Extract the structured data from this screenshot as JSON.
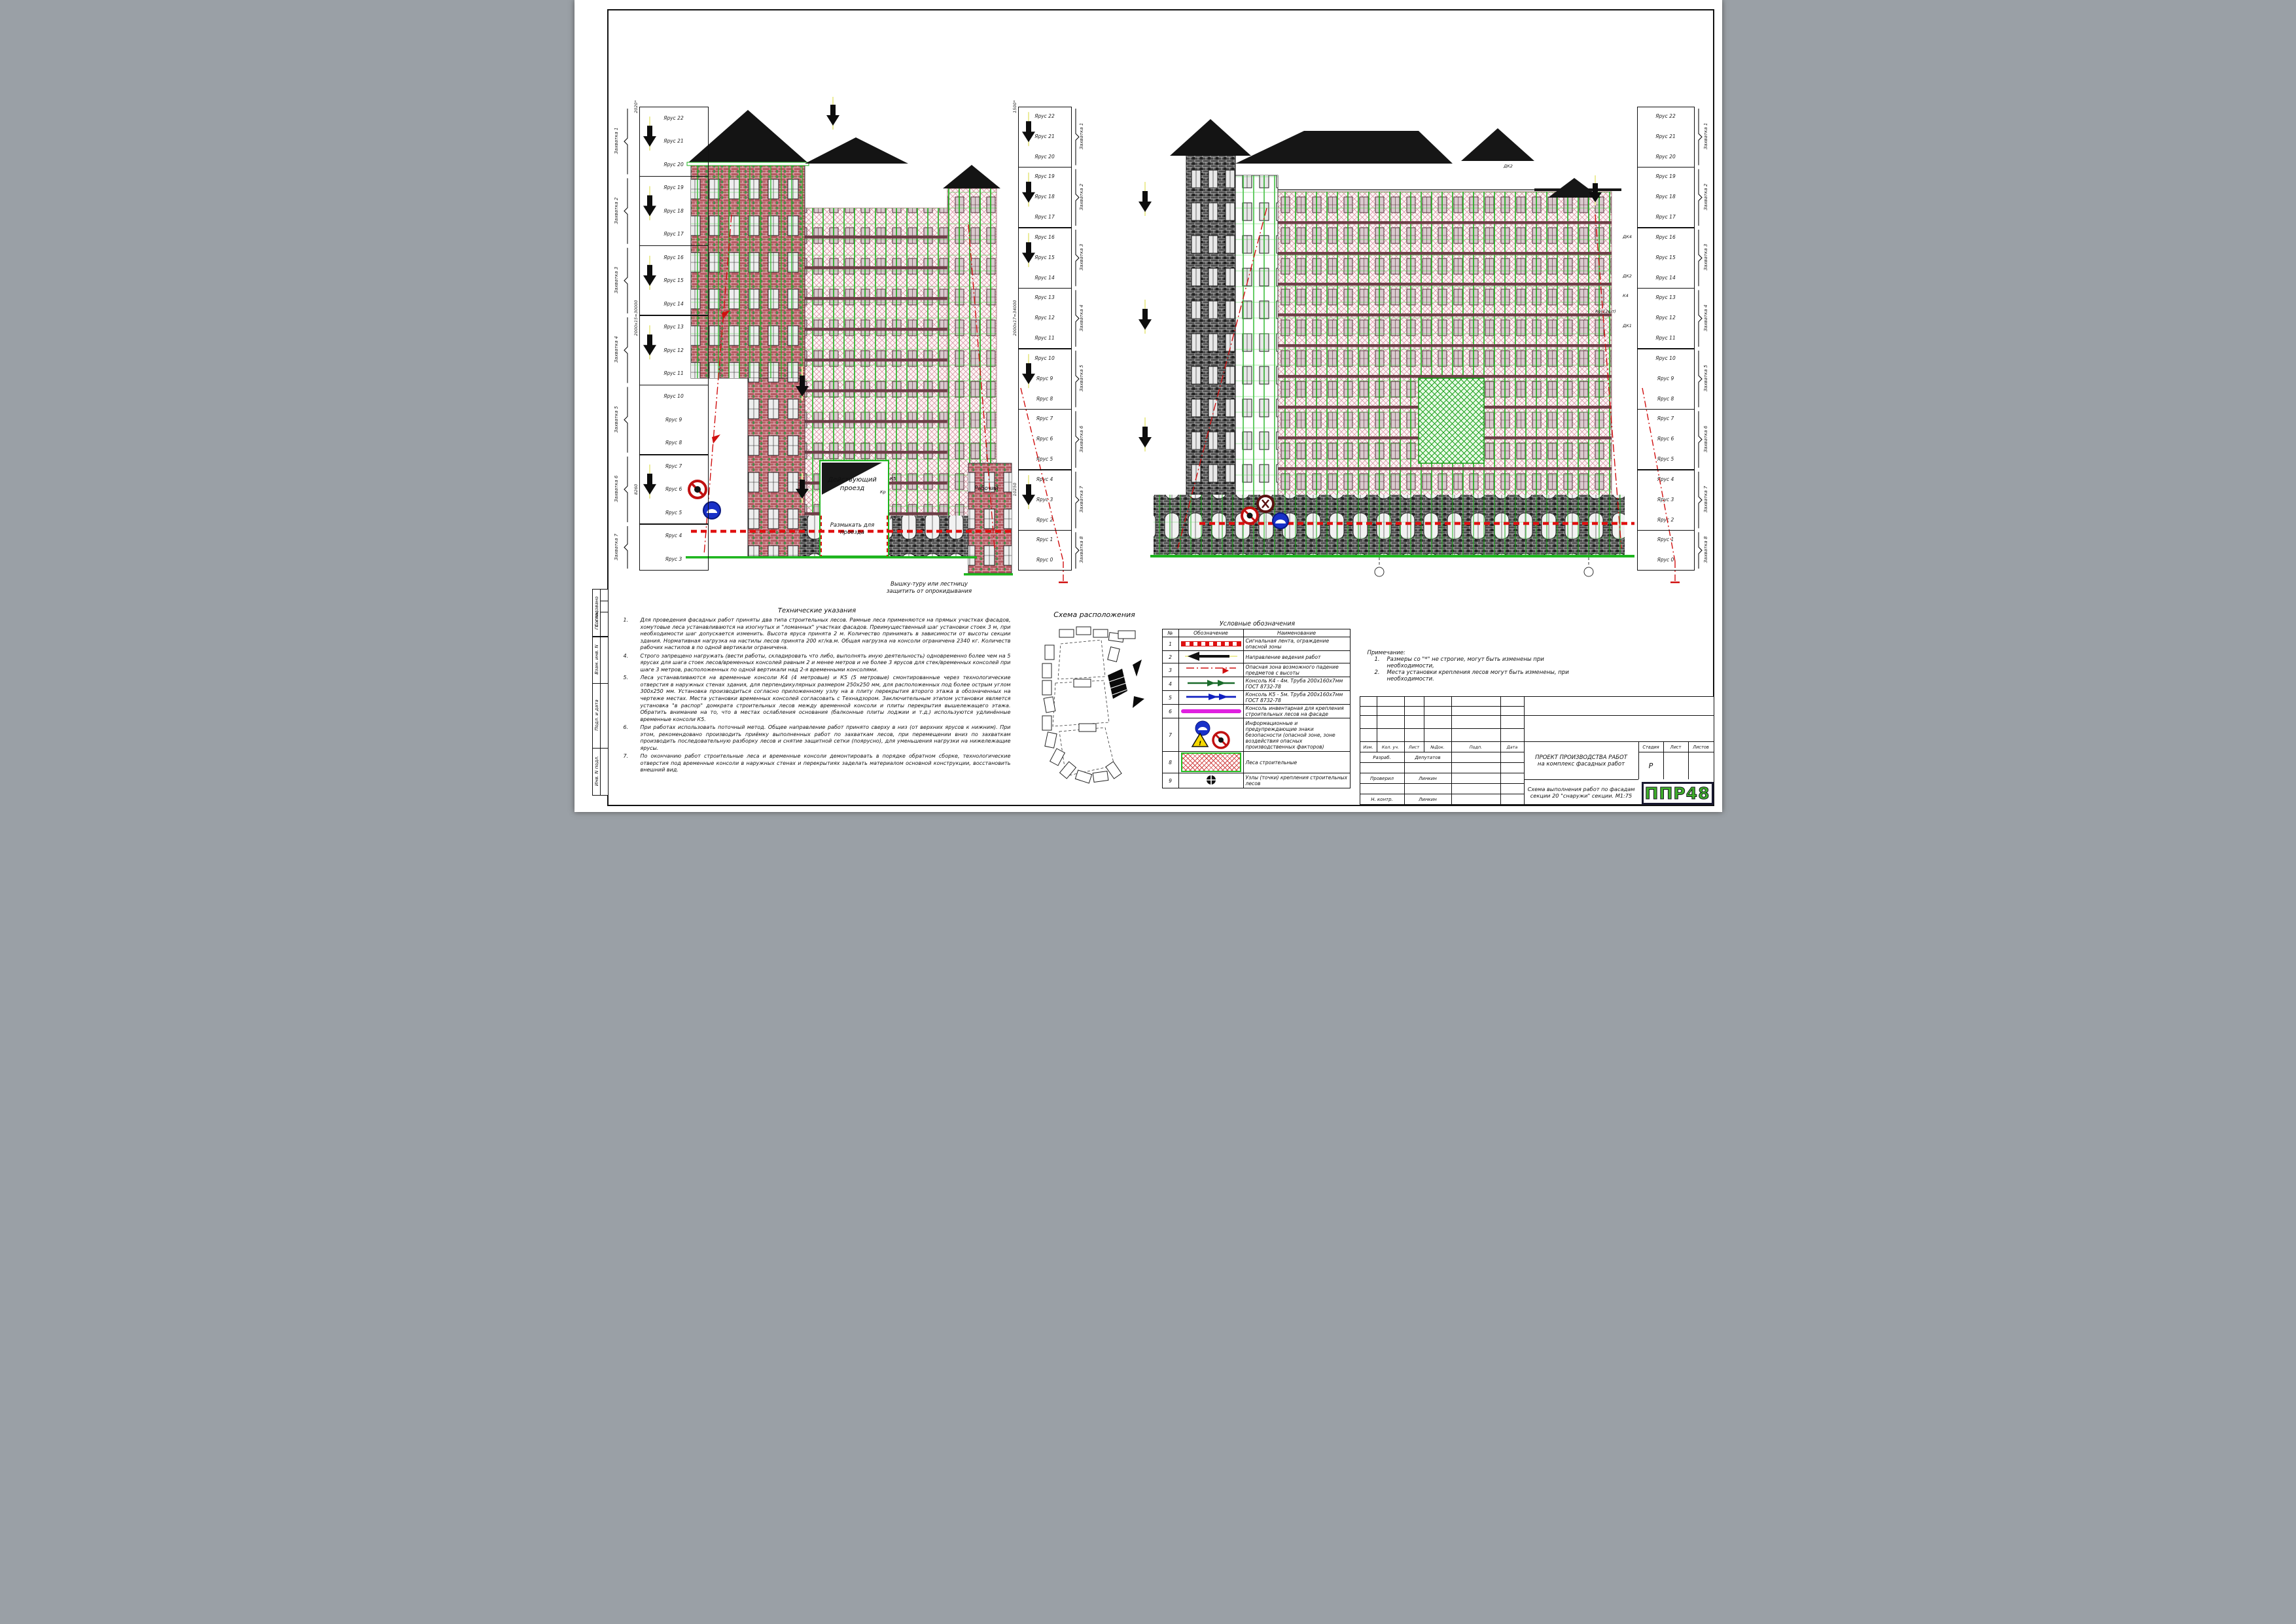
{
  "sheet_name": "Схема выполнения работ по фасадам секции 20",
  "sidebar": {
    "items": [
      "Согласовано",
      "Гл. спец.",
      "Взам. инв. N",
      "Подл. и дата",
      "Инв. N подл."
    ]
  },
  "ladders": {
    "tier_prefix": "Ярус",
    "group_prefix": "Захватка",
    "left": {
      "top_tier": 22,
      "bottom_tier": 3,
      "groups": [
        "Захватка 1",
        "Захватка 2",
        "Захватка 3",
        "Захватка 4",
        "Захватка 5",
        "Захватка 6",
        "Захватка 7"
      ],
      "dims": {
        "top": "2020*",
        "mid": "2000х15=30000",
        "bot": "8260"
      }
    },
    "middle": {
      "top_tier": 22,
      "bottom_tier": 0,
      "groups": [
        "Захватка 1",
        "Захватка 2",
        "Захватка 3",
        "Захватка 4",
        "Захватка 5",
        "Захватка 6",
        "Захватка 7",
        "Захватка 8"
      ],
      "dims": {
        "top": "1500*",
        "mid": "2000х17=34000",
        "bot": "10250"
      }
    },
    "right": {
      "top_tier": 22,
      "bottom_tier": 0,
      "groups": [
        "Захватка 1",
        "Захватка 2",
        "Захватка 3",
        "Захватка 4",
        "Захватка 5",
        "Захватка 6",
        "Захватка 7",
        "Захватка 8"
      ],
      "dims": {
        "top": "",
        "mid": "",
        "bot": ""
      }
    }
  },
  "facade1": {
    "labels": {
      "passage_l1": "Действующий",
      "passage_l2": "проезд",
      "open_l1": "Размыкать для",
      "open_l2": "проезда",
      "tower_l1": "Вышку-туру или лестницу",
      "tower_l2": "защитить от опрокидывания",
      "worker": "Рабочий"
    },
    "tags": {
      "t1": "К5",
      "t2": "Кр",
      "t3": "К5"
    }
  },
  "facade2": {
    "tags": {
      "t1": "ДК2",
      "t2": "ДК4",
      "t3": "ДК2",
      "t4": "К4",
      "t5": "ДК1",
      "t6": "Кр(12шт)"
    }
  },
  "tech_notes": {
    "title": "Технические указания",
    "items": [
      {
        "n": "1.",
        "text": "Для проведения фасадных работ приняты два типа строительных лесов. Рамные леса применяются на прямых участках фасадов, хомутовые леса устанавливаются на изогнутых и \"ломанных\" участках фасадов. Преимущественный шаг установки стоек 3 м, при необходимости шаг допускается изменить. Высота яруса принята 2 м. Количество принимать в зависимости от высоты секции здания. Нормативная нагрузка на настилы лесов принята 200 кг/кв.м. Общая нагрузка на консоли ограничена 2340 кг. Количеств рабочих настилов в по одной вертикали ограничена."
      },
      {
        "n": "4.",
        "text": "Строго запрещено нагружать (вести работы, складировать что либо, выполнять иную деятельность) одновременно более чем на 5 ярусах для шага стоек лесов/временных консолей равным 2 и менее метров и не более 3 ярусов для стек/временных консолей при шаге 3 метров, расположенных по одной вертикали над 2-я временными консолями."
      },
      {
        "n": "5.",
        "text": "Леса устанавливаются на временные консоли К4 (4 метровые) и К5 (5 метровые) смонтированные через технологические отверстия в наружных стенах здания, для перпендикулярных размером 250х250 мм, для расположенных под более острым углом 300х250 мм. Установка производиться согласно приложенному узлу на в плиту перекрытия второго этажа в обозначенных на чертеже местах. Места установки временных консолей согласовать с Технадзором. Заключительным этапом установки является установка \"в распор\" домкрата строительных лесов между временной консоли и плиты перекрытия вышележащего этажа. Обратить внимание на то, что в местах ослабления основания (балконные плиты лоджии и т.д.) используются удлинённые временные консоли К5."
      },
      {
        "n": "6.",
        "text": "При работах использовать поточный метод. Общее направление работ принято сверху в низ (от верхних ярусов к нижним). При этом, рекомендовано производить приёмку выполненных работ по захваткам лесов, при перемещении вниз по захваткам производить последовательную разборку лесов и снятие защитной сетки (поярусно), для уменьшения нагрузки на нижележащие ярусы."
      },
      {
        "n": "7.",
        "text": "По окончанию работ строительные леса и временные консоли демонтировать в порядке обратном сборке, технологические отверстия под временные консоли в наружных стенах и перекрытиях заделать материалом основной конструкции, восстановить внешний вид."
      }
    ]
  },
  "key_plan": {
    "title": "Схема расположения"
  },
  "legend": {
    "title": "Условные обозначения",
    "headers": [
      "№",
      "Обозначение",
      "Наименование"
    ],
    "rows": [
      {
        "n": "1",
        "icon": "signal-tape",
        "name": "Сигнальная лента, ограждение опасной зоны"
      },
      {
        "n": "2",
        "icon": "direction-arrow",
        "name": "Направление ведения работ"
      },
      {
        "n": "3",
        "icon": "danger-line",
        "name": "Опасная зона возможного падение предметов с высоты"
      },
      {
        "n": "4",
        "icon": "console-k4",
        "name": "Консоль К4 - 4м. Труба 200х160х7мм ГОСТ 8732-78"
      },
      {
        "n": "5",
        "icon": "console-k5",
        "name": "Консоль К5 - 5м. Труба 200х160х7мм ГОСТ 8732-78"
      },
      {
        "n": "6",
        "icon": "inventory-console",
        "name": "Консоль инвентарная для крепления строительных лесов на фасаде"
      },
      {
        "n": "7",
        "icon": "safety-signs",
        "name": "Информационные и предупреждающие знаки безопасности (опасной зоне, зоне воздействия опасных производственных факторов)"
      },
      {
        "n": "8",
        "icon": "scaffold",
        "name": "Леса строительные"
      },
      {
        "n": "9",
        "icon": "node",
        "name": "Узлы (точки) крепления строительных лесов"
      }
    ]
  },
  "notes": {
    "title": "Примечание:",
    "items": [
      {
        "n": "1.",
        "text": "Размеры со \"*\" не строгие, могут быть изменены при необходимости,"
      },
      {
        "n": "2.",
        "text": "Места установки крепления лесов могут быть изменены, при необходимости."
      }
    ]
  },
  "title_block": {
    "rev_headers": [
      "Изм.",
      "Кол. уч.",
      "Лист",
      "№Док.",
      "Подп.",
      "Дата"
    ],
    "rows": [
      {
        "role": "Разраб.",
        "name": "Депутатов"
      },
      {
        "role": "",
        "name": ""
      },
      {
        "role": "Проверил",
        "name": "Линкин"
      },
      {
        "role": "",
        "name": ""
      },
      {
        "role": "Н. контр.",
        "name": "Линкин"
      }
    ],
    "doc_title_l1": "ПРОЕКТ ПРОИЗВОДСТВА РАБОТ",
    "doc_title_l2": "на комплекс фасадных работ",
    "sheet_title_l1": "Схема выполнения работ по фасадам",
    "sheet_title_l2": "секции 20 \"снаружи\" секции. М1:75",
    "stage_headers": [
      "Стадия",
      "Лист",
      "Листов"
    ],
    "stage_value": "Р",
    "logo": "ППР48"
  },
  "colors": {
    "scaffold_green": "#1db51d",
    "net_pink": "#d08898",
    "band_maroon": "#6e4048",
    "danger_red": "#e01010",
    "logo_green": "#3fae2a"
  }
}
